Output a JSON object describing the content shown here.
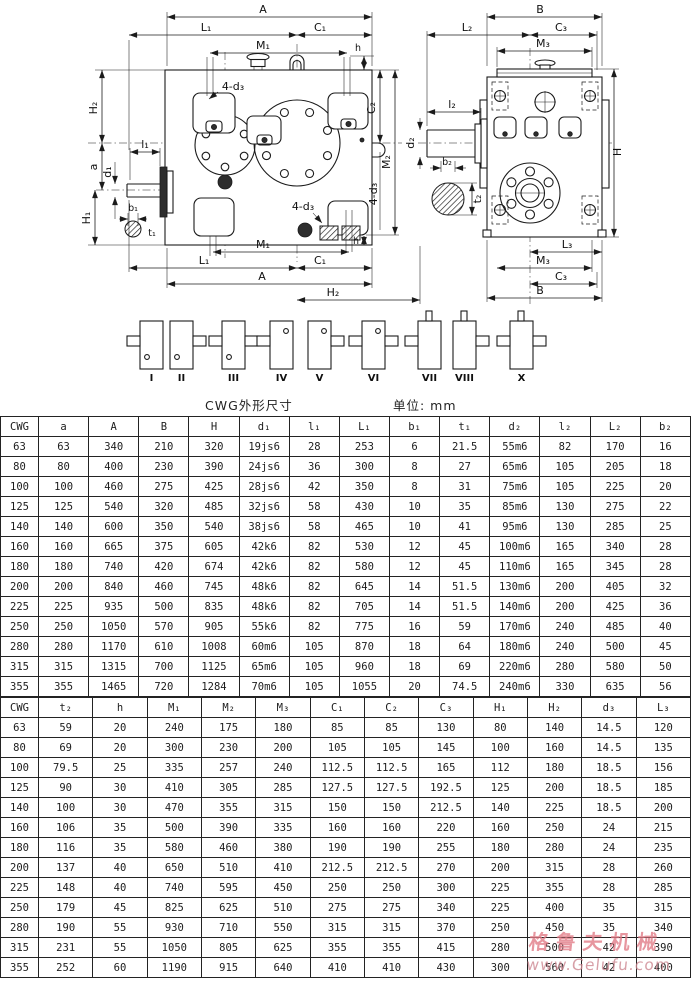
{
  "caption": {
    "title": "CWG外形尺寸",
    "unit_label": "单位: mm"
  },
  "watermark": {
    "brand": "格鲁夫机械",
    "site": "www.Gelufu.com"
  },
  "drawing": {
    "dim_labels": {
      "A": "A",
      "B": "B",
      "H": "H",
      "a": "a",
      "h": "h",
      "L1": "L₁",
      "C1": "C₁",
      "M1": "M₁",
      "H1": "H₁",
      "H2": "H₂",
      "d1": "d₁",
      "l1": "l₁",
      "b1": "b₁",
      "t1": "t₁",
      "C2": "C₂",
      "M2": "M₂",
      "d3x4": "4-d₃",
      "L2": "L₂",
      "C3": "C₃",
      "M3": "M₃",
      "l2": "l₂",
      "d2": "d₂",
      "b2": "b₂",
      "t2": "t₂",
      "L3": "L₃"
    },
    "assembly_forms": [
      "I",
      "II",
      "III",
      "IV",
      "V",
      "VI",
      "VII",
      "VIII",
      "X"
    ]
  },
  "table1": {
    "headers": [
      "CWG",
      "a",
      "A",
      "B",
      "H",
      "d₁",
      "l₁",
      "L₁",
      "b₁",
      "t₁",
      "d₂",
      "l₂",
      "L₂",
      "b₂"
    ],
    "rows": [
      [
        "63",
        "63",
        "340",
        "210",
        "320",
        "19js6",
        "28",
        "253",
        "6",
        "21.5",
        "55m6",
        "82",
        "170",
        "16"
      ],
      [
        "80",
        "80",
        "400",
        "230",
        "390",
        "24js6",
        "36",
        "300",
        "8",
        "27",
        "65m6",
        "105",
        "205",
        "18"
      ],
      [
        "100",
        "100",
        "460",
        "275",
        "425",
        "28js6",
        "42",
        "350",
        "8",
        "31",
        "75m6",
        "105",
        "225",
        "20"
      ],
      [
        "125",
        "125",
        "540",
        "320",
        "485",
        "32js6",
        "58",
        "430",
        "10",
        "35",
        "85m6",
        "130",
        "275",
        "22"
      ],
      [
        "140",
        "140",
        "600",
        "350",
        "540",
        "38js6",
        "58",
        "465",
        "10",
        "41",
        "95m6",
        "130",
        "285",
        "25"
      ],
      [
        "160",
        "160",
        "665",
        "375",
        "605",
        "42k6",
        "82",
        "530",
        "12",
        "45",
        "100m6",
        "165",
        "340",
        "28"
      ],
      [
        "180",
        "180",
        "740",
        "420",
        "674",
        "42k6",
        "82",
        "580",
        "12",
        "45",
        "110m6",
        "165",
        "345",
        "28"
      ],
      [
        "200",
        "200",
        "840",
        "460",
        "745",
        "48k6",
        "82",
        "645",
        "14",
        "51.5",
        "130m6",
        "200",
        "405",
        "32"
      ],
      [
        "225",
        "225",
        "935",
        "500",
        "835",
        "48k6",
        "82",
        "705",
        "14",
        "51.5",
        "140m6",
        "200",
        "425",
        "36"
      ],
      [
        "250",
        "250",
        "1050",
        "570",
        "905",
        "55k6",
        "82",
        "775",
        "16",
        "59",
        "170m6",
        "240",
        "485",
        "40"
      ],
      [
        "280",
        "280",
        "1170",
        "610",
        "1008",
        "60m6",
        "105",
        "870",
        "18",
        "64",
        "180m6",
        "240",
        "500",
        "45"
      ],
      [
        "315",
        "315",
        "1315",
        "700",
        "1125",
        "65m6",
        "105",
        "960",
        "18",
        "69",
        "220m6",
        "280",
        "580",
        "50"
      ],
      [
        "355",
        "355",
        "1465",
        "720",
        "1284",
        "70m6",
        "105",
        "1055",
        "20",
        "74.5",
        "240m6",
        "330",
        "635",
        "56"
      ]
    ]
  },
  "table2": {
    "headers": [
      "CWG",
      "t₂",
      "h",
      "M₁",
      "M₂",
      "M₃",
      "C₁",
      "C₂",
      "C₃",
      "H₁",
      "H₂",
      "d₃",
      "L₃"
    ],
    "rows": [
      [
        "63",
        "59",
        "20",
        "240",
        "175",
        "180",
        "85",
        "85",
        "130",
        "80",
        "140",
        "14.5",
        "120"
      ],
      [
        "80",
        "69",
        "20",
        "300",
        "230",
        "200",
        "105",
        "105",
        "145",
        "100",
        "160",
        "14.5",
        "135"
      ],
      [
        "100",
        "79.5",
        "25",
        "335",
        "257",
        "240",
        "112.5",
        "112.5",
        "165",
        "112",
        "180",
        "18.5",
        "156"
      ],
      [
        "125",
        "90",
        "30",
        "410",
        "305",
        "285",
        "127.5",
        "127.5",
        "192.5",
        "125",
        "200",
        "18.5",
        "185"
      ],
      [
        "140",
        "100",
        "30",
        "470",
        "355",
        "315",
        "150",
        "150",
        "212.5",
        "140",
        "225",
        "18.5",
        "200"
      ],
      [
        "160",
        "106",
        "35",
        "500",
        "390",
        "335",
        "160",
        "160",
        "220",
        "160",
        "250",
        "24",
        "215"
      ],
      [
        "180",
        "116",
        "35",
        "580",
        "460",
        "380",
        "190",
        "190",
        "255",
        "180",
        "280",
        "24",
        "235"
      ],
      [
        "200",
        "137",
        "40",
        "650",
        "510",
        "410",
        "212.5",
        "212.5",
        "270",
        "200",
        "315",
        "28",
        "260"
      ],
      [
        "225",
        "148",
        "40",
        "740",
        "595",
        "450",
        "250",
        "250",
        "300",
        "225",
        "355",
        "28",
        "285"
      ],
      [
        "250",
        "179",
        "45",
        "825",
        "625",
        "510",
        "275",
        "275",
        "340",
        "225",
        "400",
        "35",
        "315"
      ],
      [
        "280",
        "190",
        "55",
        "930",
        "710",
        "550",
        "315",
        "315",
        "370",
        "250",
        "450",
        "35",
        "340"
      ],
      [
        "315",
        "231",
        "55",
        "1050",
        "805",
        "625",
        "355",
        "355",
        "415",
        "280",
        "500",
        "42",
        "390"
      ],
      [
        "355",
        "252",
        "60",
        "1190",
        "915",
        "640",
        "410",
        "410",
        "430",
        "300",
        "560",
        "42",
        "400"
      ]
    ]
  }
}
